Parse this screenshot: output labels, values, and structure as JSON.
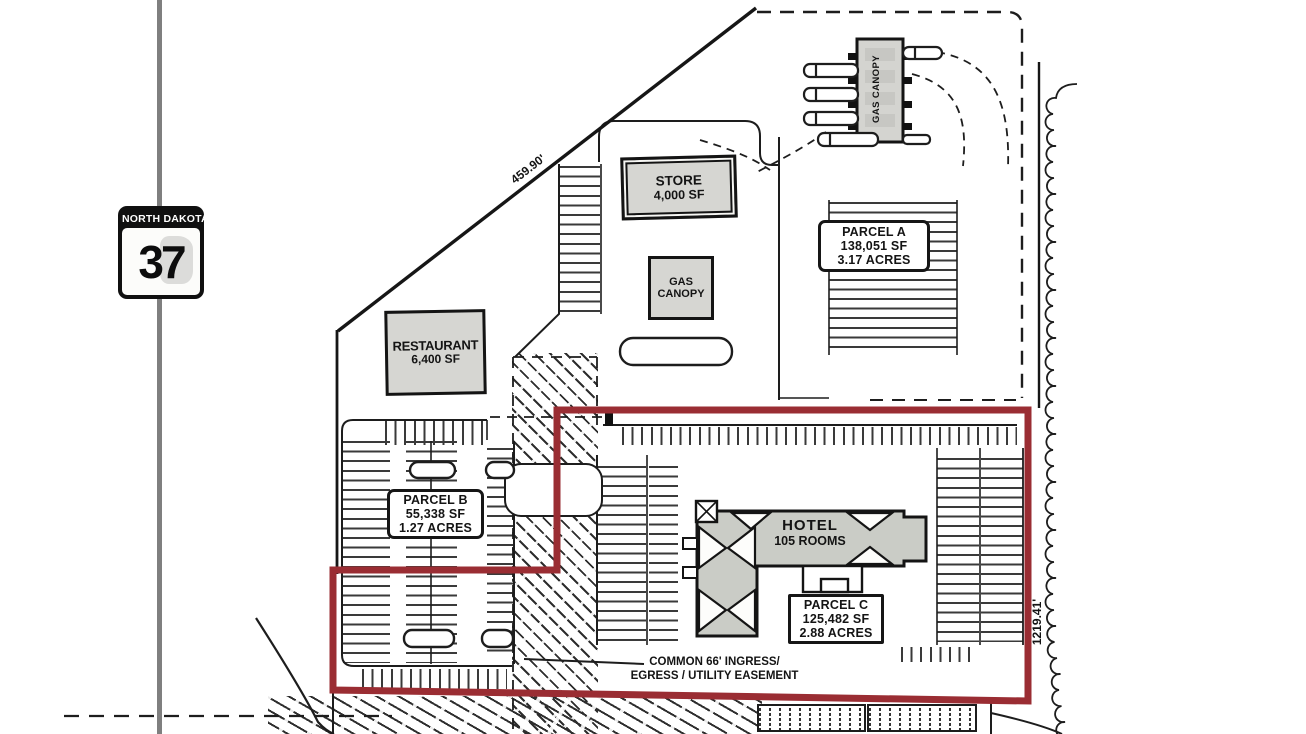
{
  "highway_sign": {
    "state_name": "NORTH DAKOTA",
    "route_number": "37"
  },
  "dimensions": {
    "northwest_boundary_length": "459.90'",
    "east_boundary_length": "1219.41'"
  },
  "buildings": {
    "store": {
      "name": "STORE",
      "area": "4,000 SF"
    },
    "gas_canopy": {
      "line1": "GAS",
      "line2": "CANOPY"
    },
    "gas_canopy_north": {
      "label": "GAS CANOPY"
    },
    "restaurant": {
      "name": "RESTAURANT",
      "area": "6,400 SF"
    },
    "hotel": {
      "name": "HOTEL",
      "detail": "105 ROOMS"
    }
  },
  "parcels": [
    {
      "name": "PARCEL A",
      "area_sf": "138,051 SF",
      "area_acres": "3.17 ACRES"
    },
    {
      "name": "PARCEL B",
      "area_sf": "55,338 SF",
      "area_acres": "1.27 ACRES"
    },
    {
      "name": "PARCEL C",
      "area_sf": "125,482 SF",
      "area_acres": "2.88 ACRES"
    }
  ],
  "easement_note": {
    "line1": "COMMON 66' INGRESS/",
    "line2": "EGRESS / UTILITY EASEMENT"
  },
  "colors": {
    "parcel_c_outline": "#9a2d33",
    "building_fill": "#d6d6d2",
    "road_gray": "#7f7f7f",
    "linework": "#1d1d1d"
  }
}
